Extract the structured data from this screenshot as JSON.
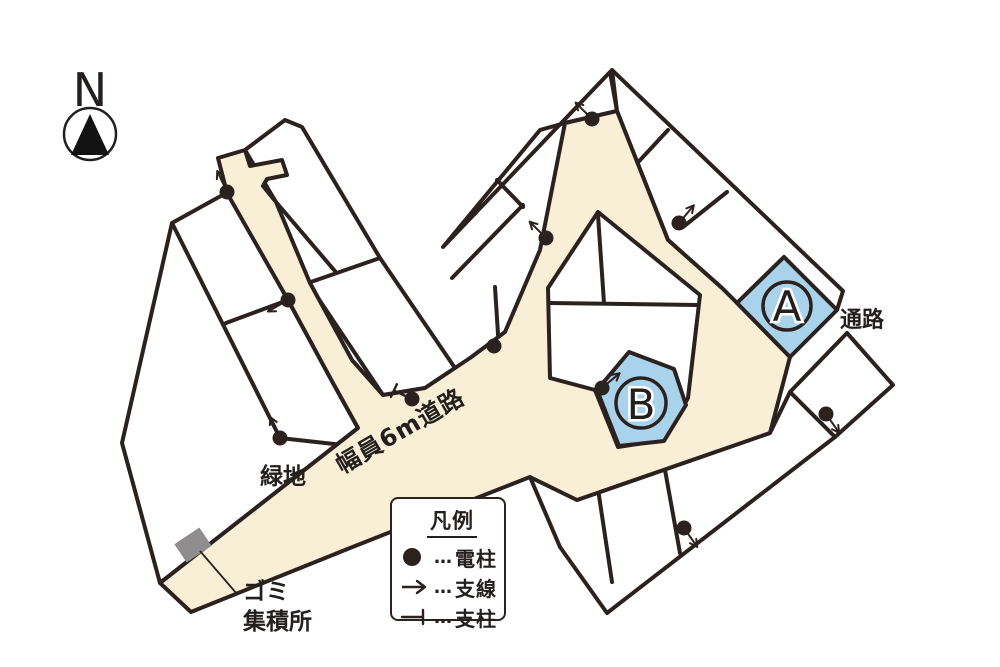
{
  "compass": {
    "letter": "N"
  },
  "map": {
    "labels": {
      "passage": "通路",
      "green_space": "緑地",
      "road_width": "幅員6m道路",
      "trash_line1": "ゴミ",
      "trash_line2": "集積所"
    },
    "lots": {
      "a": "A",
      "b": "B"
    },
    "colors": {
      "road": "#f9eed6",
      "line": "#2b2220",
      "lot_highlight": "#a9d3ea",
      "trash_area": "#8f8d8e",
      "text": "#231f1e"
    },
    "markers": [
      {
        "type": "utility-pole-with-guy-wire",
        "x": 227,
        "y": 192,
        "angle": 115
      },
      {
        "type": "utility-pole-with-guy-wire",
        "x": 288,
        "y": 300,
        "angle": 210
      },
      {
        "type": "utility-pole-with-guy-wire",
        "x": 280,
        "y": 438,
        "angle": 115
      },
      {
        "type": "utility-pole-with-guy-wire",
        "x": 592,
        "y": 119,
        "angle": 135
      },
      {
        "type": "utility-pole-with-guy-wire",
        "x": 546,
        "y": 238,
        "angle": 135
      },
      {
        "type": "utility-pole-with-guy-wire",
        "x": 679,
        "y": 223,
        "angle": 50
      },
      {
        "type": "utility-pole-with-guy-wire",
        "x": 602,
        "y": 388,
        "angle": 40
      },
      {
        "type": "utility-pole-with-guy-wire",
        "x": 826,
        "y": 414,
        "angle": -55
      },
      {
        "type": "utility-pole-with-guy-wire",
        "x": 684,
        "y": 528,
        "angle": -55
      },
      {
        "type": "utility-pole",
        "x": 494,
        "y": 346
      },
      {
        "type": "support-strut",
        "x": 412,
        "y": 399,
        "angle": 155
      }
    ]
  },
  "legend": {
    "title": "凡例",
    "ellipsis": "…",
    "items": [
      {
        "symbol": "utility-pole-symbol",
        "label": "電柱"
      },
      {
        "symbol": "guy-wire-symbol",
        "label": "支線"
      },
      {
        "symbol": "support-strut-symbol",
        "label": "支柱"
      }
    ]
  }
}
